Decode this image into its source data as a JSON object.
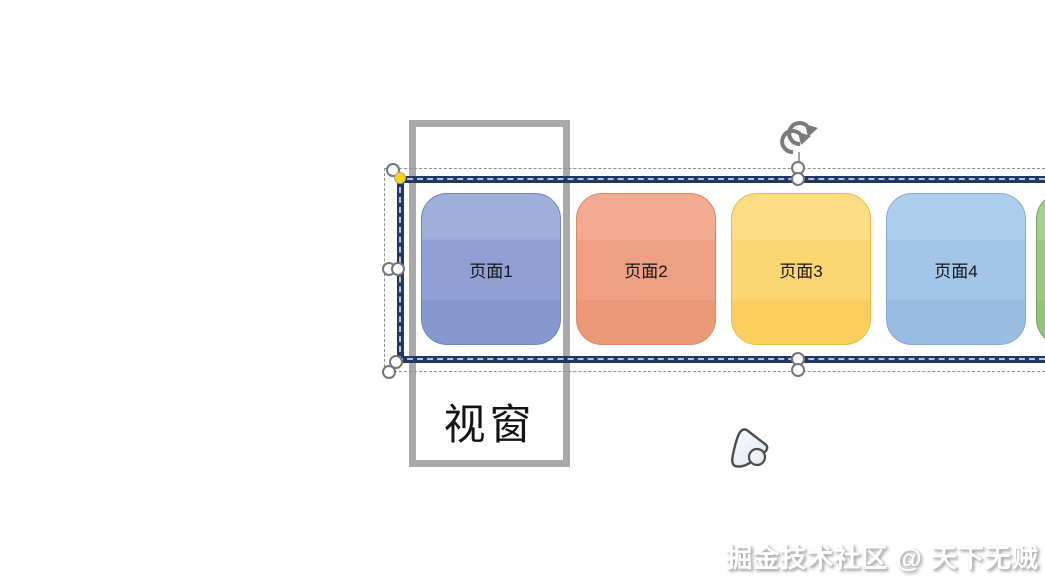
{
  "viewport_frame": {
    "label": "视窗"
  },
  "strip": {
    "pages": [
      {
        "label": "页面1",
        "left": 421,
        "fill_top": "#a0aedc",
        "fill_mid": "#90a0d5",
        "fill_bottom": "#8699cf",
        "border": "#7283c4"
      },
      {
        "label": "页面2",
        "left": 576,
        "fill_top": "#f2ab90",
        "fill_mid": "#efa083",
        "fill_bottom": "#eb9878",
        "border": "#dd8960"
      },
      {
        "label": "页面3",
        "left": 731,
        "fill_top": "#fcdc85",
        "fill_mid": "#fbd671",
        "fill_bottom": "#facf5f",
        "border": "#eebc45"
      },
      {
        "label": "页面4",
        "left": 886,
        "fill_top": "#aeceed",
        "fill_mid": "#a3c5e8",
        "fill_bottom": "#99bce2",
        "border": "#83a9d6"
      },
      {
        "label": "",
        "left": 1036,
        "fill_top": "#a5cf8c",
        "fill_mid": "#9cc981",
        "fill_bottom": "#93c377",
        "border": "#76a55c"
      }
    ]
  },
  "selection": {
    "handles": [
      {
        "type": "resize",
        "x": 393,
        "y": 170
      },
      {
        "type": "adjust",
        "x": 400,
        "y": 178
      },
      {
        "type": "resize",
        "x": 389,
        "y": 269
      },
      {
        "type": "resize",
        "x": 398,
        "y": 269
      },
      {
        "type": "resize",
        "x": 396,
        "y": 362
      },
      {
        "type": "resize",
        "x": 389,
        "y": 372
      },
      {
        "type": "resize",
        "x": 798,
        "y": 168
      },
      {
        "type": "resize",
        "x": 798,
        "y": 179
      },
      {
        "type": "resize",
        "x": 798,
        "y": 359
      },
      {
        "type": "resize",
        "x": 798,
        "y": 370
      }
    ]
  },
  "watermark": {
    "text": "掘金技术社区 @ 天下无贼"
  },
  "colors": {
    "strip_border": "#1f3864",
    "frame_border": "#a9a9a9",
    "marching_ants": "#b9c1cf",
    "selection_dash": "#8f8f8f",
    "handle_stroke": "#767676",
    "adjust_handle_fill": "#ffd500",
    "rotation_icon": "#7a7a7a"
  }
}
